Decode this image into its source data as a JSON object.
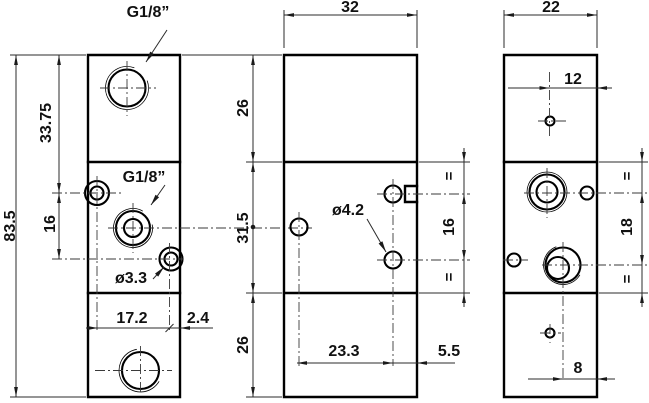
{
  "drawing": {
    "views": {
      "front": {
        "port_top_label": "G1/8”",
        "port_mid_label": "G1/8”",
        "small_hole_label": "ø3.3",
        "dim_total_height": "83.5",
        "dim_top_to_port_center": "33.75",
        "dim_hole_spacing_v": "16",
        "dim_hole_offset_x": "17.2",
        "dim_hole_edge_x": "2.4"
      },
      "side": {
        "dim_width": "32",
        "dim_top_section": "26",
        "dim_mid_section": "31.5",
        "dim_bottom_section": "26",
        "hole_label": "ø4.2",
        "dim_hole_spacing_v": "16",
        "dim_hole_offset_x": "23.3",
        "dim_hole_edge_x": "5.5",
        "eq_top": "=",
        "eq_bottom": "="
      },
      "back": {
        "dim_width": "22",
        "dim_top_hole_offset": "12",
        "dim_hole_spacing_v": "18",
        "dim_bottom_hole_offset": "8",
        "eq_top": "=",
        "eq_bottom": "="
      }
    }
  }
}
